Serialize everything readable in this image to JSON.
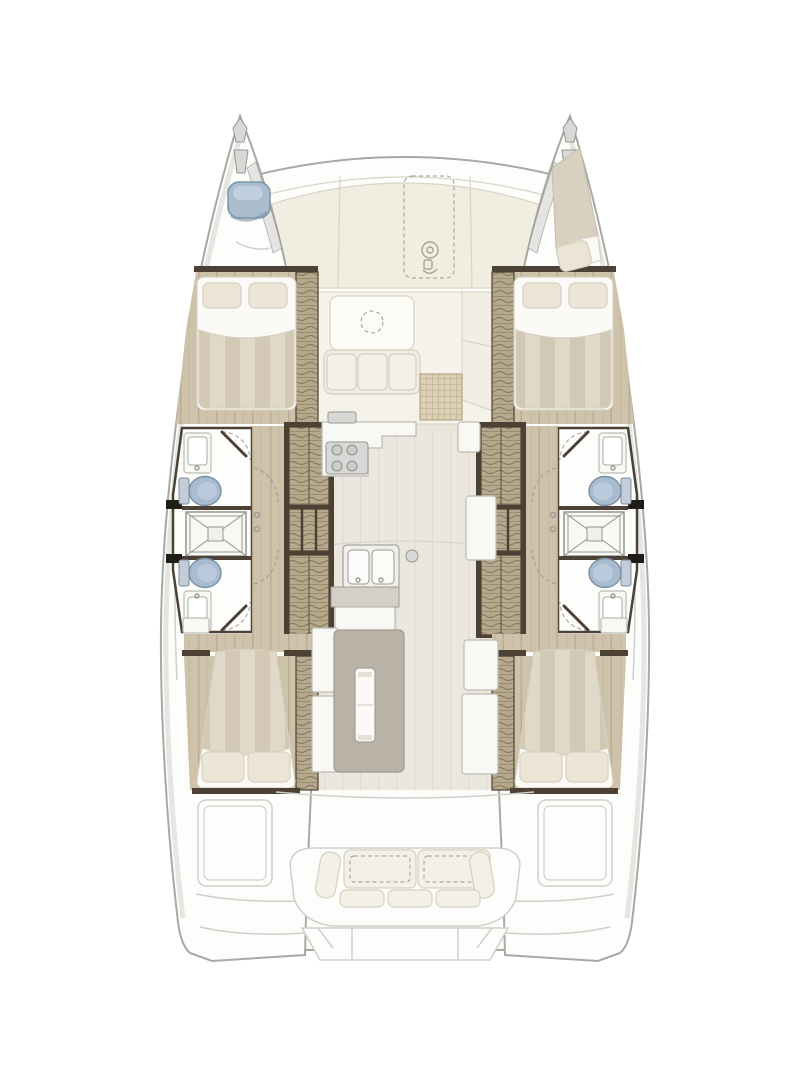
{
  "page": {
    "kind": "boat-deck-plan",
    "orientation": "bow-up"
  },
  "vessel": {
    "type": "catamaran",
    "hulls": 2,
    "double_cabins": 4,
    "bow_berths": 1,
    "bathrooms": 4,
    "showers": 2,
    "toilets": 4,
    "bathroom_sinks": 4,
    "galley_sink_basins": 2,
    "stair_flights": 4,
    "aft_bench_seat_cushions": 3,
    "forward_cockpit_tables": 1,
    "saloon_tables": 1
  },
  "rooms": {
    "foredeck": "foredeck",
    "windlass_locker": "anchor-windlass-locker",
    "forward_cockpit": "forward-cockpit-lounge",
    "saloon": "saloon",
    "galley": "galley",
    "port_forward_cabin": "port-forward-cabin",
    "port_forward_bathroom": "port-forward-bathroom",
    "port_shower": "port-shower",
    "port_aft_bathroom": "port-aft-bathroom",
    "port_aft_cabin": "port-aft-cabin",
    "starboard_forward_cabin": "starboard-forward-cabin",
    "starboard_forward_bathroom": "starboard-forward-bathroom",
    "starboard_shower": "starboard-shower",
    "starboard_aft_bathroom": "starboard-aft-bathroom",
    "starboard_aft_cabin": "starboard-aft-cabin",
    "port_bow_locker": "port-bow-hatch-locker",
    "starboard_bow_berth": "starboard-bow-berth",
    "aft_cockpit": "aft-cockpit",
    "swim_platform": "transom-steps"
  },
  "colors": {
    "paper": "#ffffff",
    "hull-white": "#fdfdfc",
    "hull-line": "#a8a8a4",
    "hull-shadow": "#dededa",
    "deck-ivory": "#f1ede1",
    "deck-seam": "#d9d4c6",
    "fwd-deck": "#f5f2ea",
    "fixture": "#f8f8f5",
    "fixture-line": "#bcbcb5",
    "panel-line": "#cfcfca",
    "cushion": "#f3f0e7",
    "cushion-line": "#d6d0c0",
    "linen": "#fbfaf7",
    "pillow": "#ece5d5",
    "wall": "#4c4134",
    "stub-black": "#201c16",
    "wood": "#cec2ab",
    "wood-line": "#b9ac92",
    "stair": "#b5a88c",
    "stair-line": "#82735a",
    "stair-tread": "#9b8d70",
    "bedstripe-a": "#e1d9c7",
    "bedstripe-b": "#d2c8b3",
    "toilet": "#a7bccf",
    "toilet-line": "#7b8fa2",
    "tank": "#c3cdd8",
    "dash-line": "#9b9b94",
    "grate": "#dccfb3",
    "grate-line": "#b5a585",
    "table": "#b9b2a6",
    "table-line": "#a19a8d",
    "metal": "#d8d8d6",
    "metal-line": "#97978f",
    "saloon-floor": "#ebe7de",
    "saloon-floor-line": "#e0dbd0",
    "shower-line": "#8e8e88",
    "blue-hatch": "#a9bdcd",
    "blue-hatch-line": "#7e93a5",
    "counter-grey": "#d3d0c8"
  }
}
